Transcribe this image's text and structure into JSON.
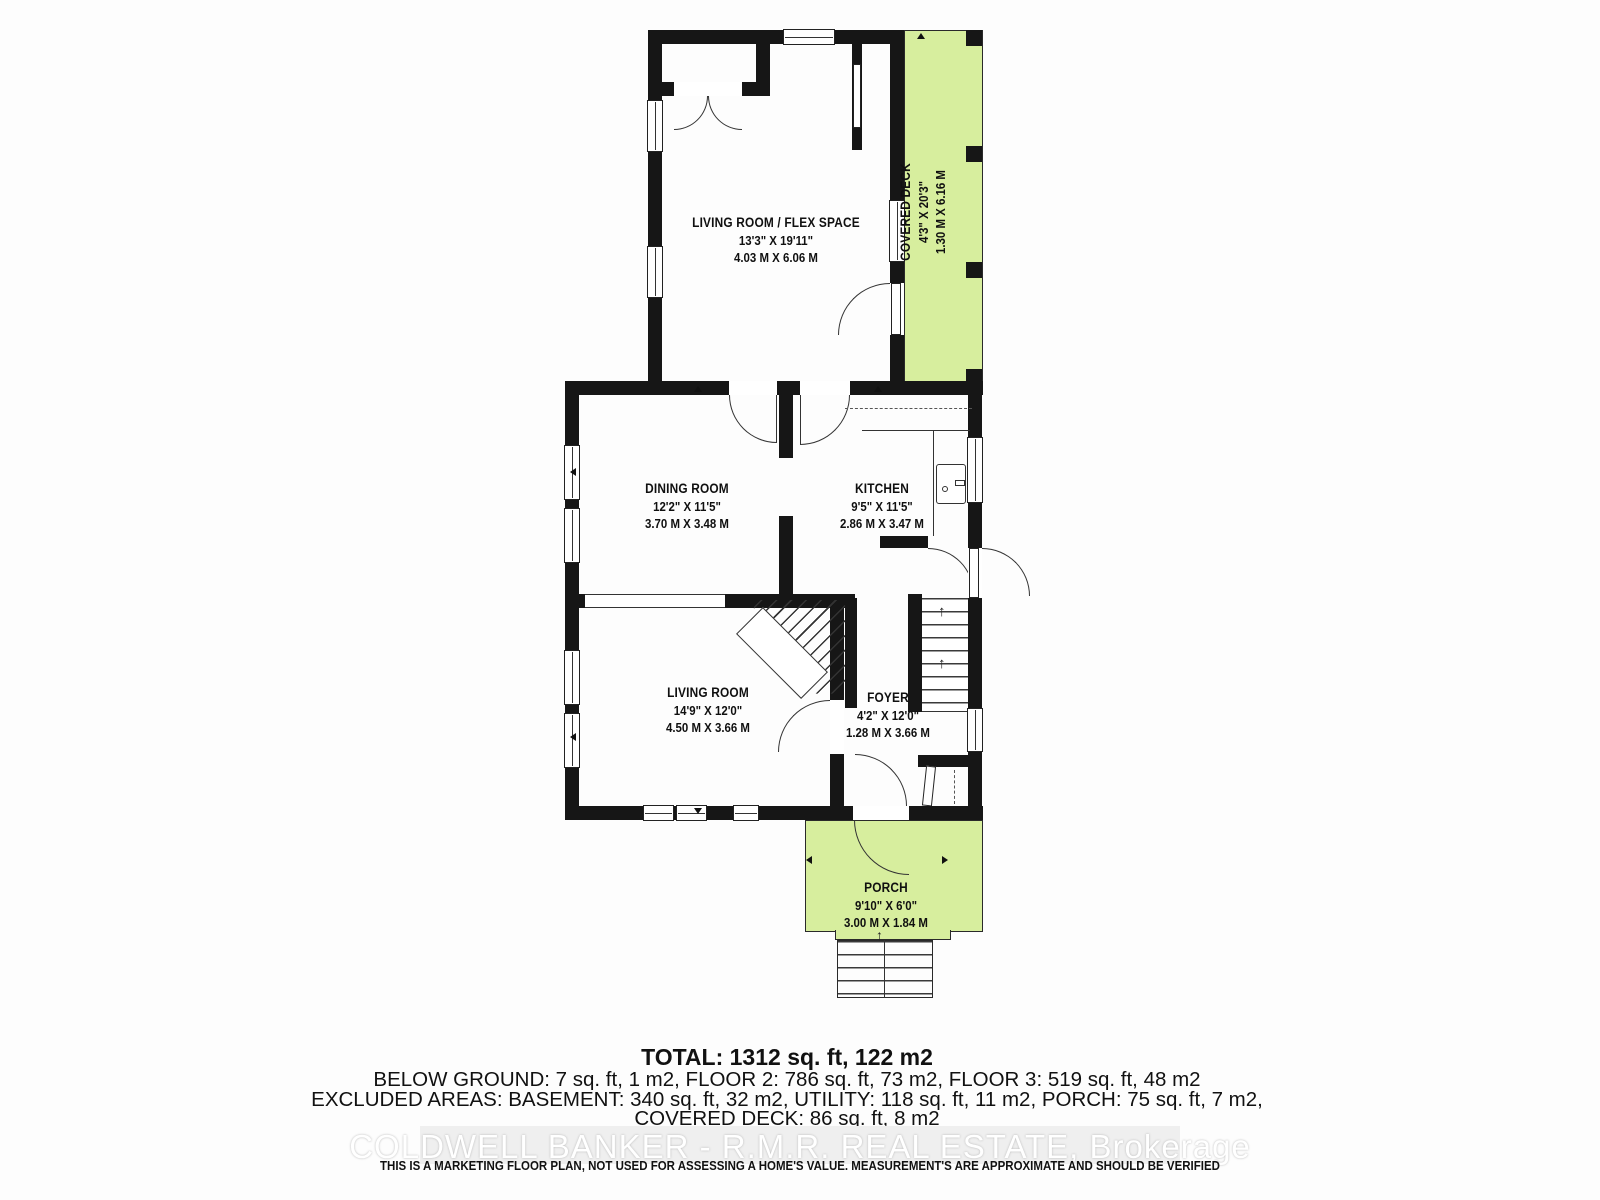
{
  "plan": {
    "rooms": {
      "flex": {
        "name": "LIVING ROOM / FLEX SPACE",
        "ft": "13'3\" X 19'11\"",
        "m": "4.03 M X 6.06 M"
      },
      "dining": {
        "name": "DINING ROOM",
        "ft": "12'2\" X 11'5\"",
        "m": "3.70 M X 3.48 M"
      },
      "kitchen": {
        "name": "KITCHEN",
        "ft": "9'5\" X 11'5\"",
        "m": "2.86 M X 3.47 M"
      },
      "living": {
        "name": "LIVING ROOM",
        "ft": "14'9\" X 12'0\"",
        "m": "4.50 M X 3.66 M"
      },
      "foyer": {
        "name": "FOYER",
        "ft": "4'2\" X 12'0\"",
        "m": "1.28 M X 3.66 M"
      },
      "deck": {
        "name": "COVERED DECK",
        "ft": "4'3\" X 20'3\"",
        "m": "1.30 M X 6.16 M"
      },
      "porch": {
        "name": "PORCH",
        "ft": "9'10\" X 6'0\"",
        "m": "3.00 M X 1.84 M"
      }
    }
  },
  "summary": {
    "total": "TOTAL: 1312 sq. ft, 122 m2",
    "line2": "BELOW GROUND: 7 sq. ft, 1 m2, FLOOR 2: 786 sq. ft, 73 m2, FLOOR 3: 519 sq. ft, 48 m2",
    "line3": "EXCLUDED AREAS: BASEMENT: 340 sq. ft, 32 m2, UTILITY: 118 sq. ft, 11 m2, PORCH: 75 sq. ft, 7 m2,",
    "line4": "COVERED DECK: 86 sq. ft, 8 m2",
    "line5": "WALLS: 161 sq. ft, 15 m2"
  },
  "watermark": "COLDWELL BANKER - R.M.R. REAL ESTATE, Brokerage",
  "disclaimer": "THIS IS A MARKETING FLOOR PLAN, NOT USED FOR ASSESSING A HOME'S VALUE. MEASUREMENT'S ARE APPROXIMATE AND SHOULD BE VERIFIED",
  "icons": {
    "up_arrow": "↑"
  },
  "colors": {
    "wall": "#161616",
    "deck_green": "#d7ee9e",
    "line": "#333333"
  }
}
